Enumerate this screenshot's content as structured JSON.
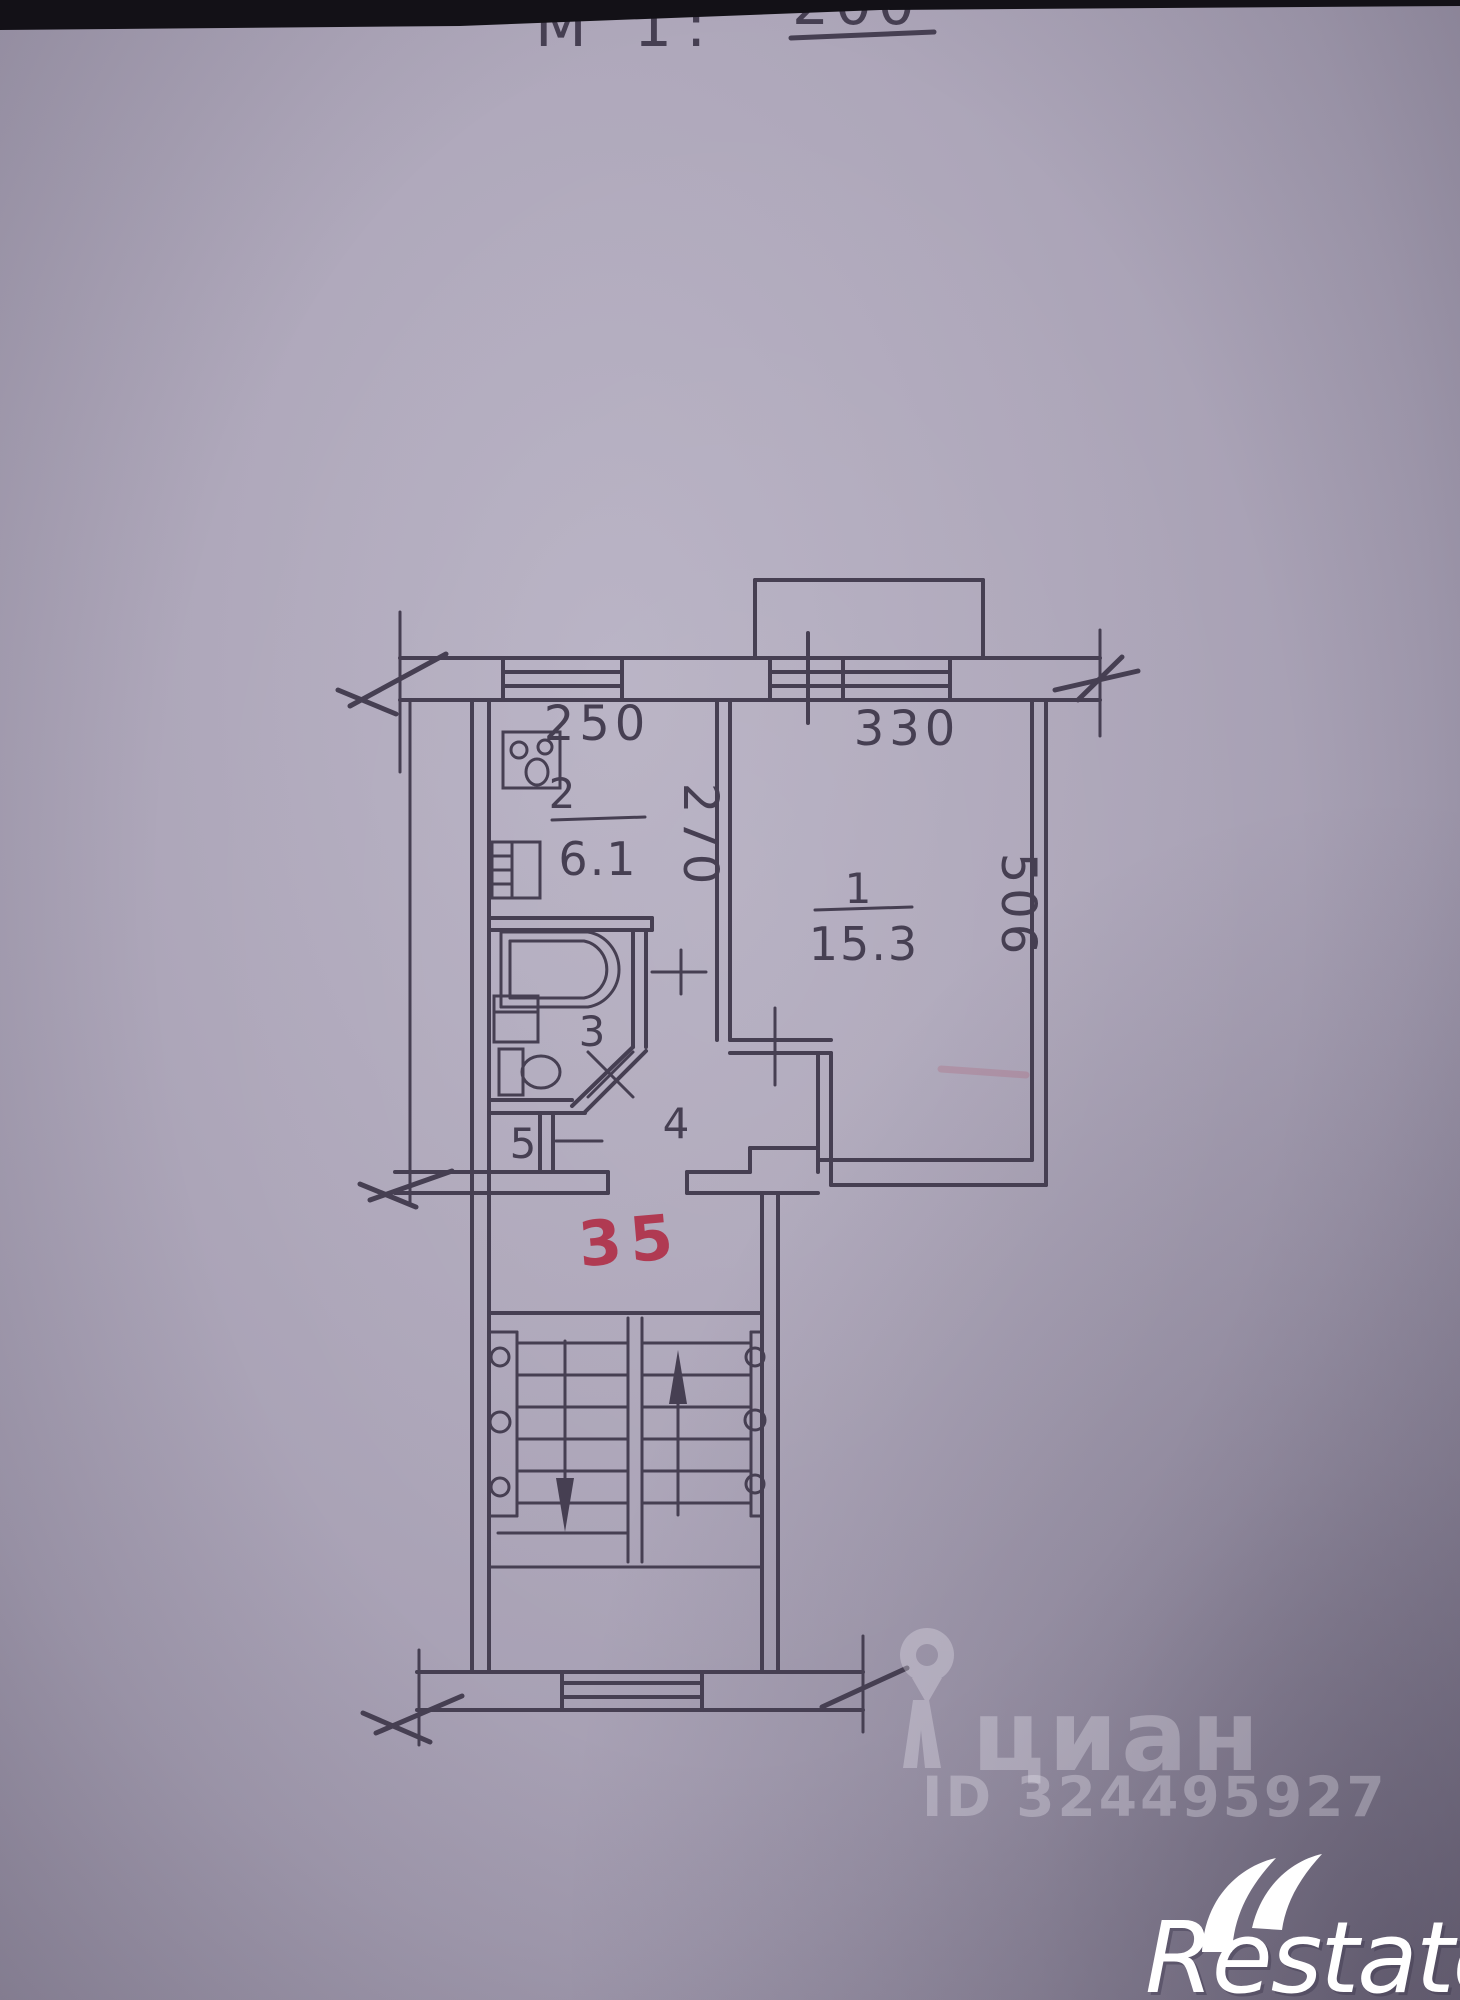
{
  "photo": {
    "scale_note": {
      "prefix": "М 1:",
      "value": "200"
    },
    "colors": {
      "paper": "#aba4b7",
      "ink": "#463f52",
      "red_mark": "#b03a52",
      "watermark_white": "#e9e6f0"
    }
  },
  "plan": {
    "dimensions": {
      "kitchen_width": "250",
      "room_width": "330",
      "kitchen_depth": "270",
      "room_depth": "506"
    },
    "rooms": {
      "living": {
        "number": "1",
        "area": "15.3"
      },
      "kitchen": {
        "number": "2",
        "area": "6.1"
      },
      "bathroom": {
        "number": "3"
      },
      "hall": {
        "number": "4"
      },
      "wc": {
        "number": "5"
      }
    },
    "apartment_number": "35"
  },
  "watermark": {
    "brand": "циан",
    "id_text": "ID 324495927"
  },
  "logo": {
    "text": "Restate"
  }
}
